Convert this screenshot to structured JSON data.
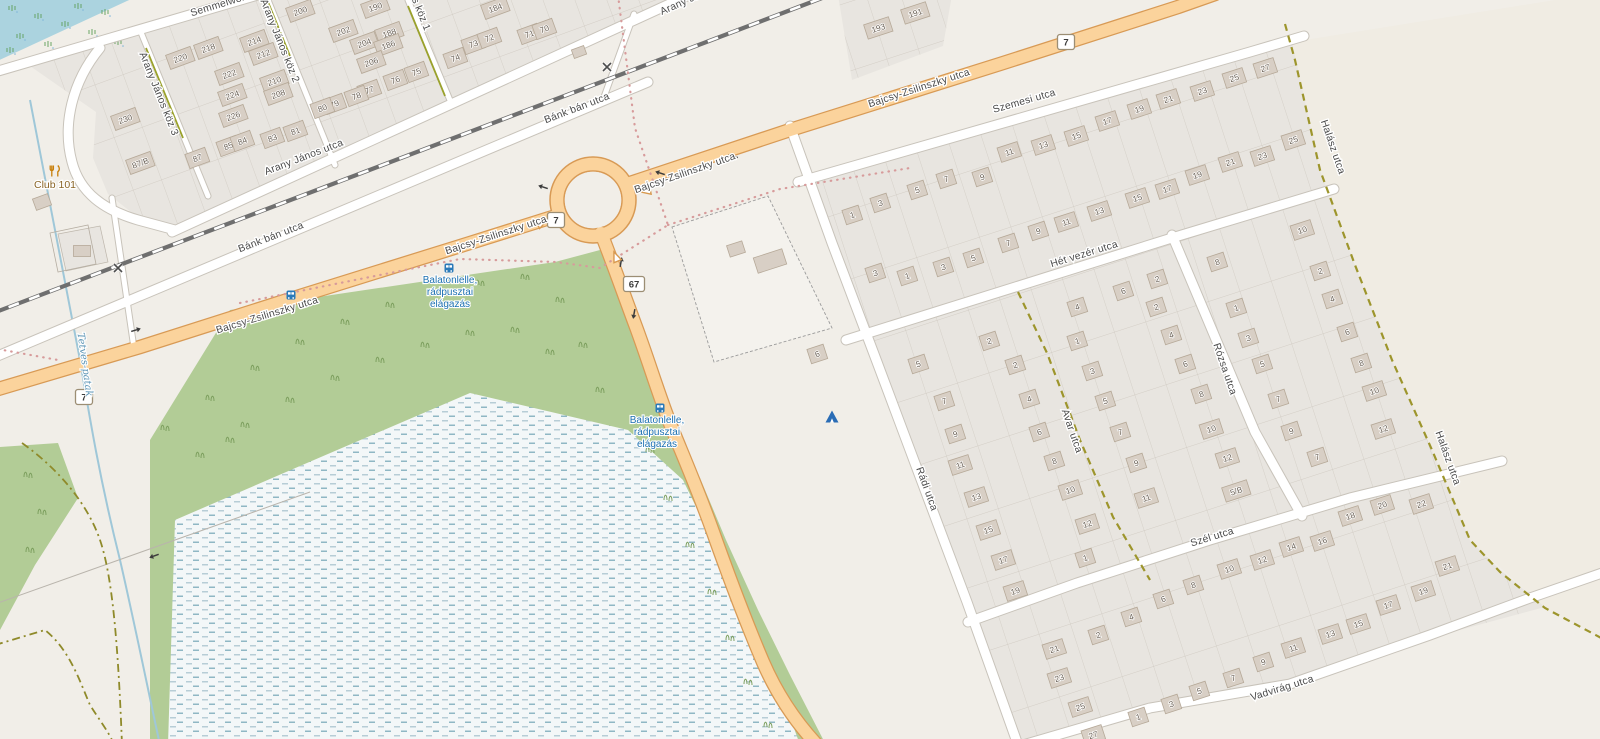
{
  "map": {
    "colors": {
      "base": "#f1eee8",
      "water": "#abd3df",
      "wetland_bg": "#f3f7f8",
      "wetland_dash": "#8fb7c4",
      "green": "#b2cc96",
      "residential": "#e8e5e0",
      "building": "#d8cfc5",
      "building_border": "#b6a998",
      "road_main_fill": "#fbd39c",
      "road_main_casing": "#d89a55",
      "road_white": "#ffffff",
      "track_olive": "#9d952c",
      "rail": "#6f6f6f",
      "boundary_dots": "#d79b9b",
      "transit_blue": "#1b6fb0",
      "stream": "#9fc7d8"
    },
    "street_labels": [
      {
        "t": "Semmelweis utca",
        "x": 232,
        "y": 4,
        "r": -17,
        "k": "road"
      },
      {
        "t": "Arany János köz 3",
        "x": 156,
        "y": 95,
        "r": 68,
        "k": "road"
      },
      {
        "t": "Arany János köz 2",
        "x": 277,
        "y": 42,
        "r": 68,
        "k": "road"
      },
      {
        "t": "Arany János köz 1",
        "x": 408,
        "y": -10,
        "r": 68,
        "k": "road"
      },
      {
        "t": "Arany János utca",
        "x": 305,
        "y": 160,
        "r": -21,
        "k": "road"
      },
      {
        "t": "Arany János utca",
        "x": 700,
        "y": -2,
        "r": -24,
        "k": "road"
      },
      {
        "t": "Bánk bán utca",
        "x": 272,
        "y": 240,
        "r": -21,
        "k": "road"
      },
      {
        "t": "Bánk bán utca",
        "x": 578,
        "y": 111,
        "r": -21,
        "k": "road"
      },
      {
        "t": "Bajcsy-Zsilinszky utca",
        "x": 268,
        "y": 318,
        "r": -17,
        "k": "road"
      },
      {
        "t": "Bajcsy-Zsilinszky utca",
        "x": 497,
        "y": 238,
        "r": -18,
        "k": "road"
      },
      {
        "t": "Bajcsy-Zsilinszky utca",
        "x": 686,
        "y": 176,
        "r": -19,
        "k": "road"
      },
      {
        "t": "Bajcsy-Zsilinszky utca",
        "x": 920,
        "y": 91,
        "r": -18,
        "k": "road"
      },
      {
        "t": "Szemesi utca",
        "x": 1025,
        "y": 104,
        "r": -16,
        "k": "road"
      },
      {
        "t": "Hét vezér utca",
        "x": 1085,
        "y": 257,
        "r": -17,
        "k": "road"
      },
      {
        "t": "Szél utca",
        "x": 1213,
        "y": 540,
        "r": -17,
        "k": "road"
      },
      {
        "t": "Vadvirág utca",
        "x": 1283,
        "y": 691,
        "r": -17,
        "k": "road"
      },
      {
        "t": "Rádi utca",
        "x": 924,
        "y": 490,
        "r": 70,
        "k": "road"
      },
      {
        "t": "Avar utca",
        "x": 1069,
        "y": 432,
        "r": 71,
        "k": "road"
      },
      {
        "t": "Rózsa utca",
        "x": 1222,
        "y": 370,
        "r": 71,
        "k": "road"
      },
      {
        "t": "Halász utca",
        "x": 1330,
        "y": 148,
        "r": 71,
        "k": "road"
      },
      {
        "t": "Halász utca",
        "x": 1445,
        "y": 459,
        "r": 70,
        "k": "road"
      },
      {
        "t": "Tetves-patak",
        "x": 82,
        "y": 365,
        "r": 82,
        "k": "water"
      },
      {
        "t": "Club 101",
        "x": 55,
        "y": 188,
        "r": 0,
        "k": "poi"
      }
    ],
    "transit_stops": [
      {
        "lines": [
          "Balatonlelle,",
          "rádpusztai",
          "elágazás"
        ],
        "x": 450,
        "y": 283
      },
      {
        "lines": [
          "Balatonlelle,",
          "rádpusztai",
          "elágazás"
        ],
        "x": 657,
        "y": 423
      }
    ],
    "route_shields": [
      {
        "ref": "7",
        "x": 84,
        "y": 397
      },
      {
        "ref": "7",
        "x": 556,
        "y": 220
      },
      {
        "ref": "67",
        "x": 634,
        "y": 284
      },
      {
        "ref": "7",
        "x": 1066,
        "y": 42
      }
    ],
    "house_numbers": [
      [
        "230",
        125,
        118
      ],
      [
        "87/B",
        140,
        162
      ],
      [
        "87",
        197,
        157
      ],
      [
        "85",
        228,
        145
      ],
      [
        "84",
        242,
        140
      ],
      [
        "83",
        272,
        137
      ],
      [
        "81",
        295,
        130
      ],
      [
        "226",
        233,
        115
      ],
      [
        "224",
        232,
        94
      ],
      [
        "222",
        229,
        73
      ],
      [
        "220",
        180,
        57
      ],
      [
        "218",
        208,
        47
      ],
      [
        "214",
        254,
        40
      ],
      [
        "212",
        263,
        53
      ],
      [
        "210",
        274,
        80
      ],
      [
        "208",
        278,
        93
      ],
      [
        "200",
        300,
        10
      ],
      [
        "190",
        375,
        6
      ],
      [
        "202",
        343,
        30
      ],
      [
        "204",
        364,
        42
      ],
      [
        "188",
        389,
        32
      ],
      [
        "186",
        388,
        44
      ],
      [
        "206",
        371,
        61
      ],
      [
        "184",
        495,
        7
      ],
      [
        "76",
        395,
        79
      ],
      [
        "75",
        416,
        71
      ],
      [
        "74",
        455,
        57
      ],
      [
        "73",
        473,
        43
      ],
      [
        "72",
        489,
        37
      ],
      [
        "71",
        529,
        33
      ],
      [
        "70",
        544,
        28
      ],
      [
        "77",
        369,
        89
      ],
      [
        "78",
        356,
        95
      ],
      [
        "79",
        334,
        103
      ],
      [
        "80",
        322,
        107
      ],
      [
        "193",
        878,
        27
      ],
      [
        "191",
        915,
        12
      ],
      [
        "1",
        852,
        214
      ],
      [
        "3",
        880,
        202
      ],
      [
        "5",
        917,
        189
      ],
      [
        "7",
        946,
        178
      ],
      [
        "9",
        982,
        176
      ],
      [
        "11",
        1009,
        151
      ],
      [
        "13",
        1043,
        144
      ],
      [
        "15",
        1076,
        135
      ],
      [
        "17",
        1107,
        120
      ],
      [
        "19",
        1139,
        108
      ],
      [
        "21",
        1168,
        98
      ],
      [
        "23",
        1202,
        90
      ],
      [
        "25",
        1234,
        77
      ],
      [
        "27",
        1265,
        67
      ],
      [
        "3",
        875,
        272
      ],
      [
        "1",
        907,
        275
      ],
      [
        "3",
        943,
        266
      ],
      [
        "5",
        973,
        257
      ],
      [
        "7",
        1008,
        242
      ],
      [
        "9",
        1038,
        230
      ],
      [
        "11",
        1066,
        221
      ],
      [
        "13",
        1099,
        210
      ],
      [
        "15",
        1137,
        197
      ],
      [
        "17",
        1167,
        188
      ],
      [
        "19",
        1197,
        174
      ],
      [
        "21",
        1230,
        161
      ],
      [
        "23",
        1262,
        155
      ],
      [
        "25",
        1293,
        139
      ],
      [
        "4",
        1077,
        306
      ],
      [
        "6",
        1123,
        290
      ],
      [
        "2",
        1157,
        278
      ],
      [
        "5",
        918,
        363
      ],
      [
        "7",
        944,
        400
      ],
      [
        "9",
        955,
        433
      ],
      [
        "11",
        960,
        464
      ],
      [
        "13",
        976,
        496
      ],
      [
        "15",
        988,
        529
      ],
      [
        "17",
        1003,
        559
      ],
      [
        "19",
        1015,
        590
      ],
      [
        "2",
        989,
        340
      ],
      [
        "2",
        1015,
        364
      ],
      [
        "4",
        1029,
        398
      ],
      [
        "6",
        1039,
        431
      ],
      [
        "8",
        1054,
        460
      ],
      [
        "10",
        1070,
        489
      ],
      [
        "12",
        1087,
        523
      ],
      [
        "1",
        1085,
        557
      ],
      [
        "1",
        1077,
        340
      ],
      [
        "3",
        1092,
        370
      ],
      [
        "5",
        1105,
        400
      ],
      [
        "7",
        1120,
        431
      ],
      [
        "9",
        1136,
        462
      ],
      [
        "11",
        1146,
        497
      ],
      [
        "2",
        1156,
        306
      ],
      [
        "4",
        1171,
        334
      ],
      [
        "6",
        1185,
        363
      ],
      [
        "8",
        1201,
        393
      ],
      [
        "10",
        1211,
        428
      ],
      [
        "12",
        1227,
        457
      ],
      [
        "5/B",
        1236,
        490
      ],
      [
        "8",
        1217,
        261
      ],
      [
        "1",
        1236,
        307
      ],
      [
        "3",
        1248,
        337
      ],
      [
        "5",
        1262,
        363
      ],
      [
        "7",
        1278,
        398
      ],
      [
        "9",
        1291,
        430
      ],
      [
        "7",
        1317,
        456
      ],
      [
        "10",
        1302,
        229
      ],
      [
        "2",
        1320,
        270
      ],
      [
        "4",
        1332,
        298
      ],
      [
        "6",
        1347,
        331
      ],
      [
        "8",
        1361,
        362
      ],
      [
        "10",
        1374,
        390
      ],
      [
        "12",
        1383,
        428
      ],
      [
        "2",
        1098,
        634
      ],
      [
        "4",
        1131,
        616
      ],
      [
        "6",
        1163,
        598
      ],
      [
        "8",
        1193,
        584
      ],
      [
        "10",
        1229,
        568
      ],
      [
        "12",
        1262,
        559
      ],
      [
        "14",
        1291,
        546
      ],
      [
        "16",
        1322,
        540
      ],
      [
        "18",
        1350,
        515
      ],
      [
        "20",
        1382,
        504
      ],
      [
        "22",
        1421,
        503
      ],
      [
        "21",
        1447,
        565
      ],
      [
        "19",
        1423,
        590
      ],
      [
        "17",
        1388,
        604
      ],
      [
        "15",
        1358,
        623
      ],
      [
        "13",
        1330,
        633
      ],
      [
        "11",
        1293,
        647
      ],
      [
        "9",
        1263,
        661
      ],
      [
        "7",
        1233,
        677
      ],
      [
        "5",
        1199,
        690
      ],
      [
        "3",
        1171,
        703
      ],
      [
        "1",
        1138,
        716
      ],
      [
        "21",
        1054,
        648
      ],
      [
        "23",
        1059,
        677
      ],
      [
        "25",
        1080,
        706
      ],
      [
        "27",
        1093,
        734
      ],
      [
        "6",
        817,
        353
      ]
    ],
    "icons": [
      {
        "type": "bus-stop",
        "x": 291,
        "y": 295
      },
      {
        "type": "bus-stop",
        "x": 449,
        "y": 268
      },
      {
        "type": "bus-stop",
        "x": 660,
        "y": 408
      },
      {
        "type": "campsite",
        "x": 832,
        "y": 417
      },
      {
        "type": "restaurant",
        "x": 55,
        "y": 171
      },
      {
        "type": "level-crossing",
        "x": 118,
        "y": 268
      },
      {
        "type": "level-crossing",
        "x": 607,
        "y": 67
      }
    ],
    "symbols": {
      "oneway_arrows": [
        {
          "x": 543,
          "y": 187,
          "d": 198
        },
        {
          "x": 660,
          "y": 173,
          "d": 198
        },
        {
          "x": 733,
          "y": 156,
          "d": 198
        },
        {
          "x": 136,
          "y": 330,
          "d": -17
        },
        {
          "x": 621,
          "y": 262,
          "d": -80
        },
        {
          "x": 634,
          "y": 314,
          "d": 100
        },
        {
          "x": 154,
          "y": 556,
          "d": 160
        }
      ],
      "give_way": [
        {
          "x": 542,
          "y": 223,
          "r": -25
        },
        {
          "x": 646,
          "y": 191,
          "r": 170
        },
        {
          "x": 616,
          "y": 257,
          "r": -112
        }
      ]
    }
  }
}
